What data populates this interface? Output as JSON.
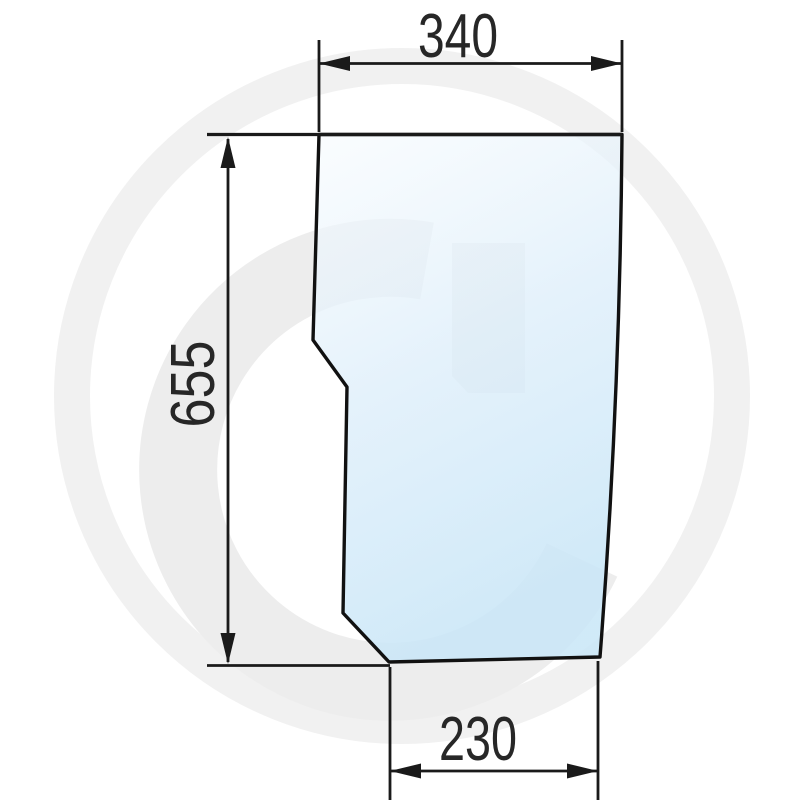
{
  "drawing": {
    "dim_top": "340",
    "dim_left": "655",
    "dim_bottom": "230",
    "watermark_letter": "G",
    "colors": {
      "outline": "#111111",
      "dimension_line": "#1a1a1a",
      "dimension_text": "#272727",
      "glass_light": "#f7fbfe",
      "glass_mid": "#ddeefa",
      "glass_dark": "#c9e6f7",
      "watermark_ring": "#f1f1f1",
      "watermark_g": "#ededed"
    }
  }
}
